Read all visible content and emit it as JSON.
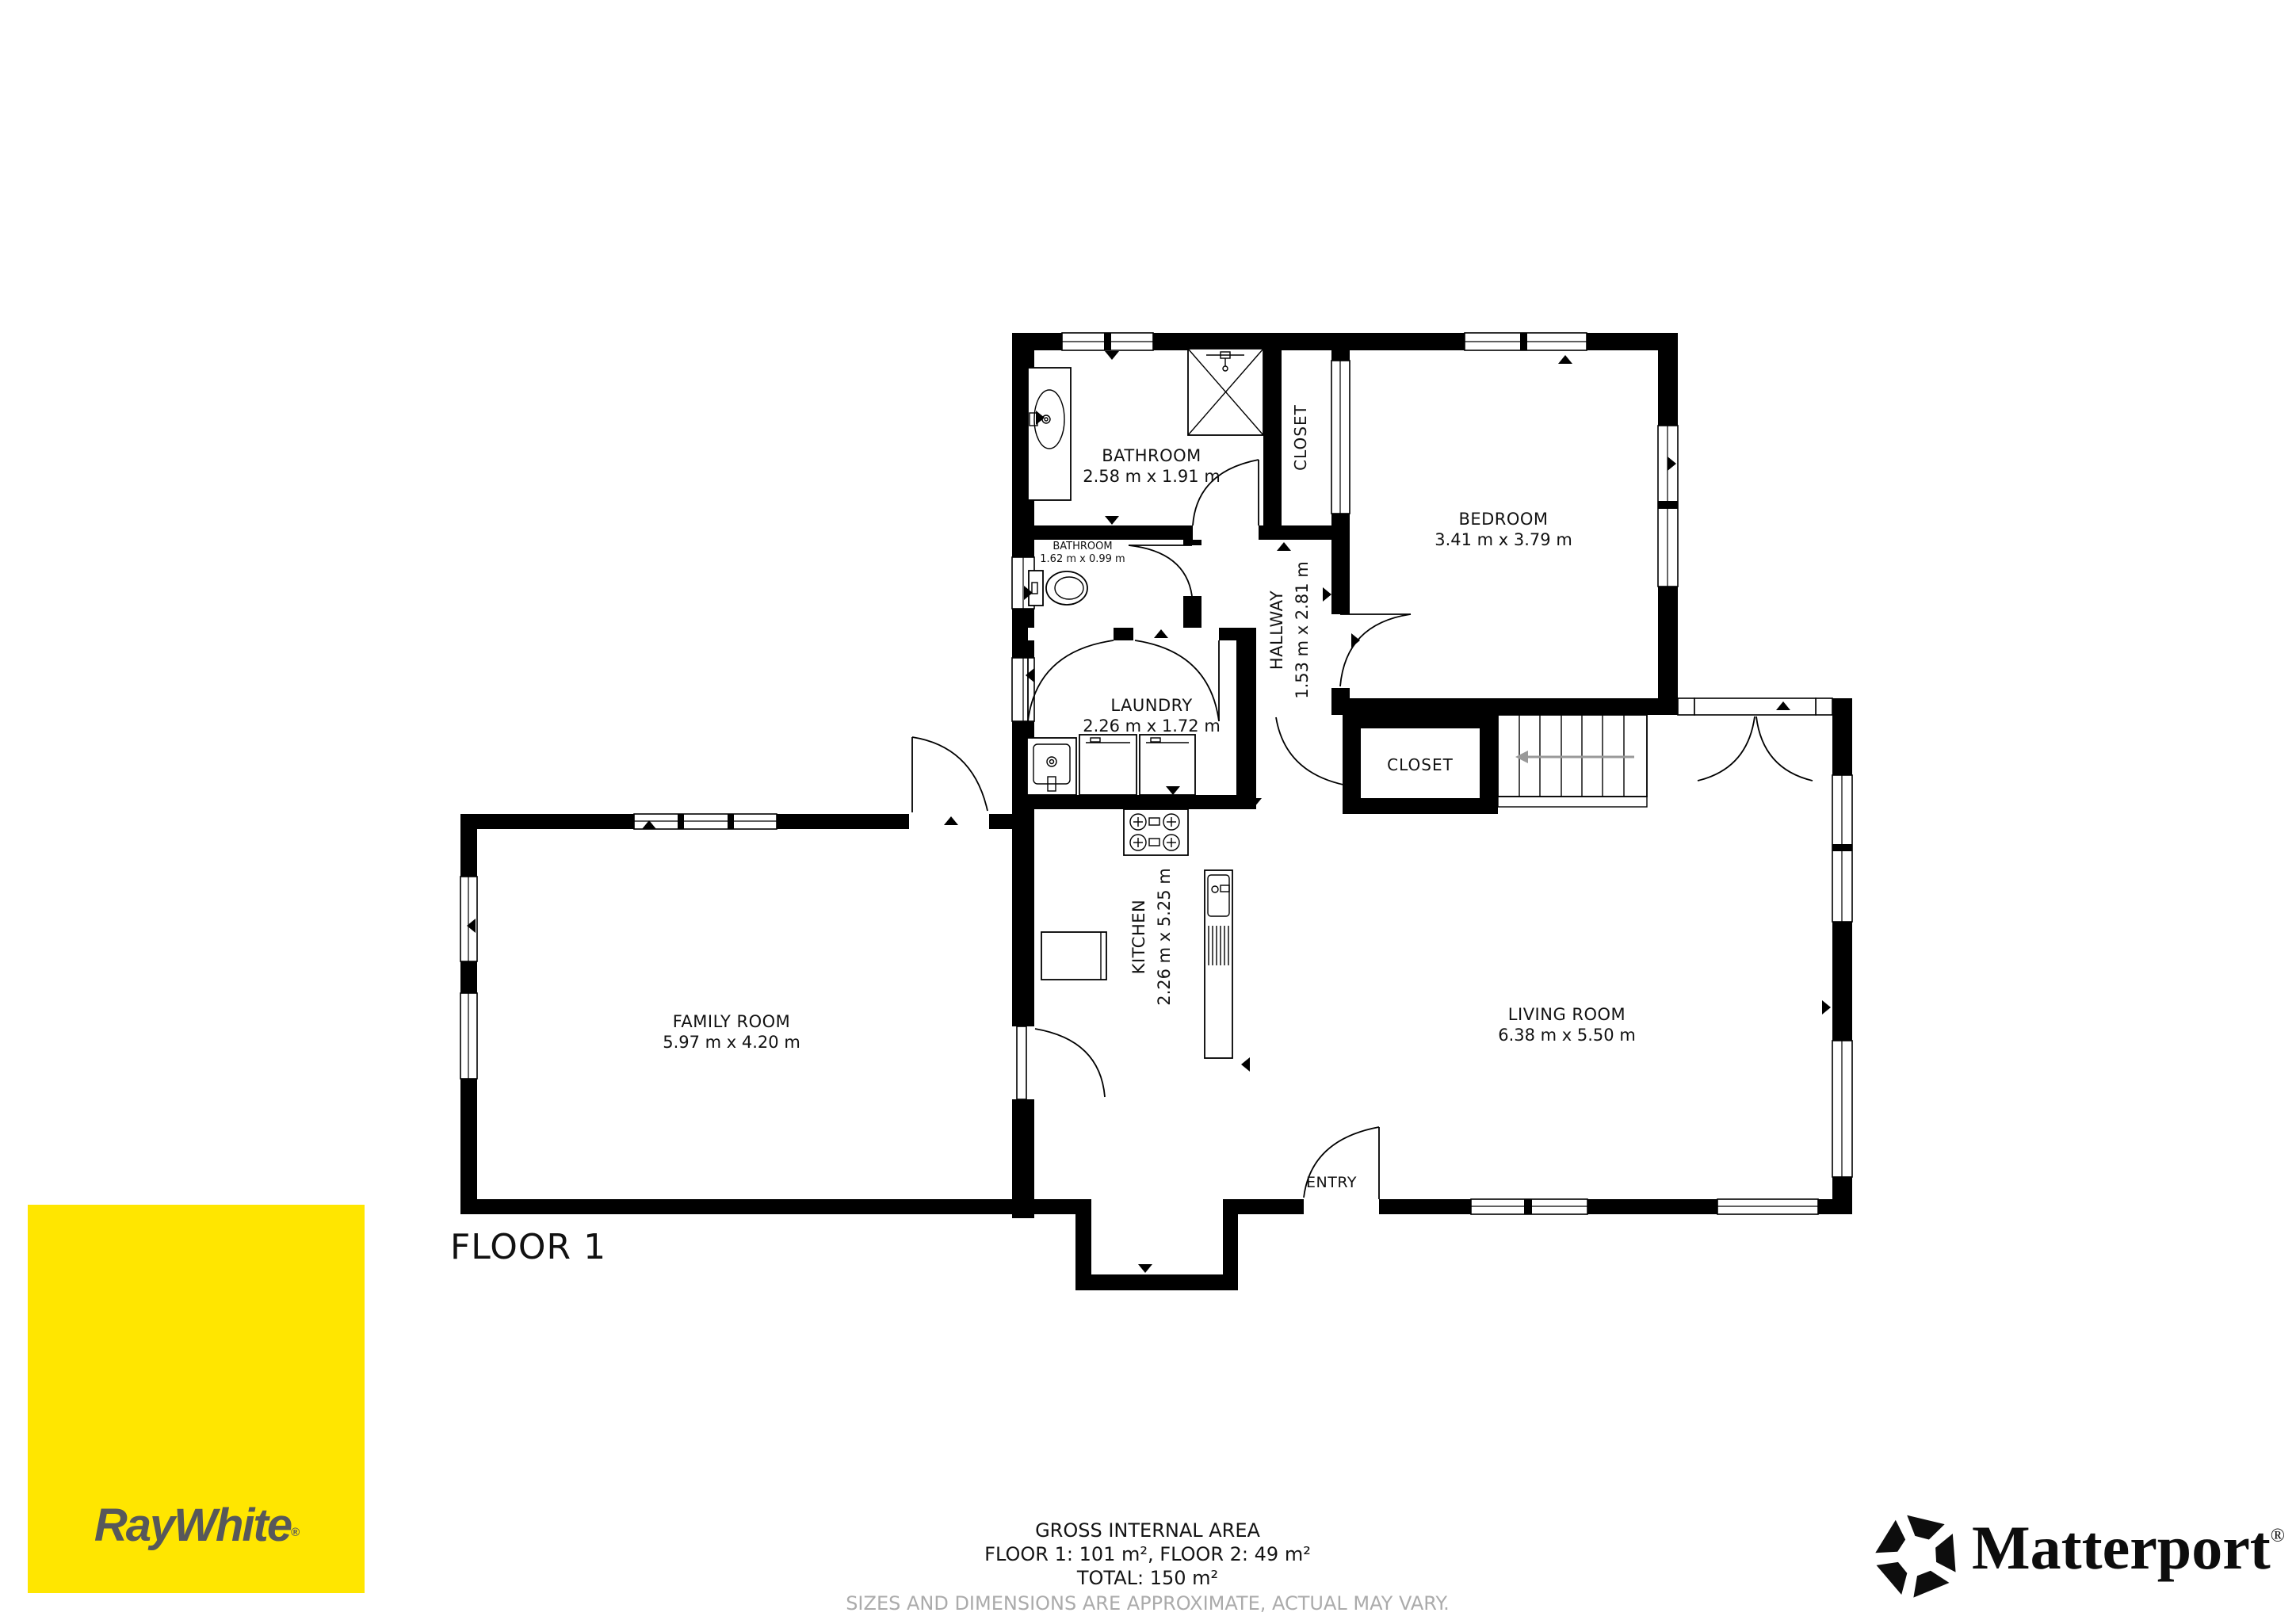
{
  "floor": {
    "label": "FLOOR 1"
  },
  "rooms": {
    "bathroom_main": {
      "name": "BATHROOM",
      "dims": "2.58 m x 1.91 m"
    },
    "bathroom_small": {
      "name": "BATHROOM",
      "dims": "1.62 m x 0.99 m"
    },
    "closet_upper": {
      "name": "CLOSET"
    },
    "bedroom": {
      "name": "BEDROOM",
      "dims": "3.41 m x 3.79 m"
    },
    "hallway": {
      "name": "HALLWAY",
      "dims": "1.53 m x 2.81 m"
    },
    "laundry": {
      "name": "LAUNDRY",
      "dims": "2.26 m x 1.72 m"
    },
    "closet_lower": {
      "name": "CLOSET"
    },
    "family_room": {
      "name": "FAMILY ROOM",
      "dims": "5.97 m x 4.20 m"
    },
    "kitchen": {
      "name": "KITCHEN",
      "dims": "2.26 m x 5.25 m"
    },
    "living_room": {
      "name": "LIVING ROOM",
      "dims": "6.38 m x 5.50 m"
    },
    "entry": {
      "name": "ENTRY"
    }
  },
  "footer": {
    "title": "GROSS INTERNAL AREA",
    "floors": "FLOOR 1: 101 m², FLOOR 2: 49 m²",
    "total": "TOTAL: 150 m²",
    "disclaimer": "SIZES AND DIMENSIONS ARE APPROXIMATE, ACTUAL MAY VARY."
  },
  "branding": {
    "raywhite": {
      "wordmark": "RayWhite",
      "registered": "®",
      "bg_color": "#FFE600",
      "text_color": "#57585A"
    },
    "matterport": {
      "wordmark": "Matterport",
      "registered": "®",
      "color": "#0D0D0D"
    }
  },
  "colors": {
    "walls": "#000000",
    "labels": "#111111",
    "disclaimer_text": "#ABABAB",
    "stairs_arrow": "#999999"
  }
}
